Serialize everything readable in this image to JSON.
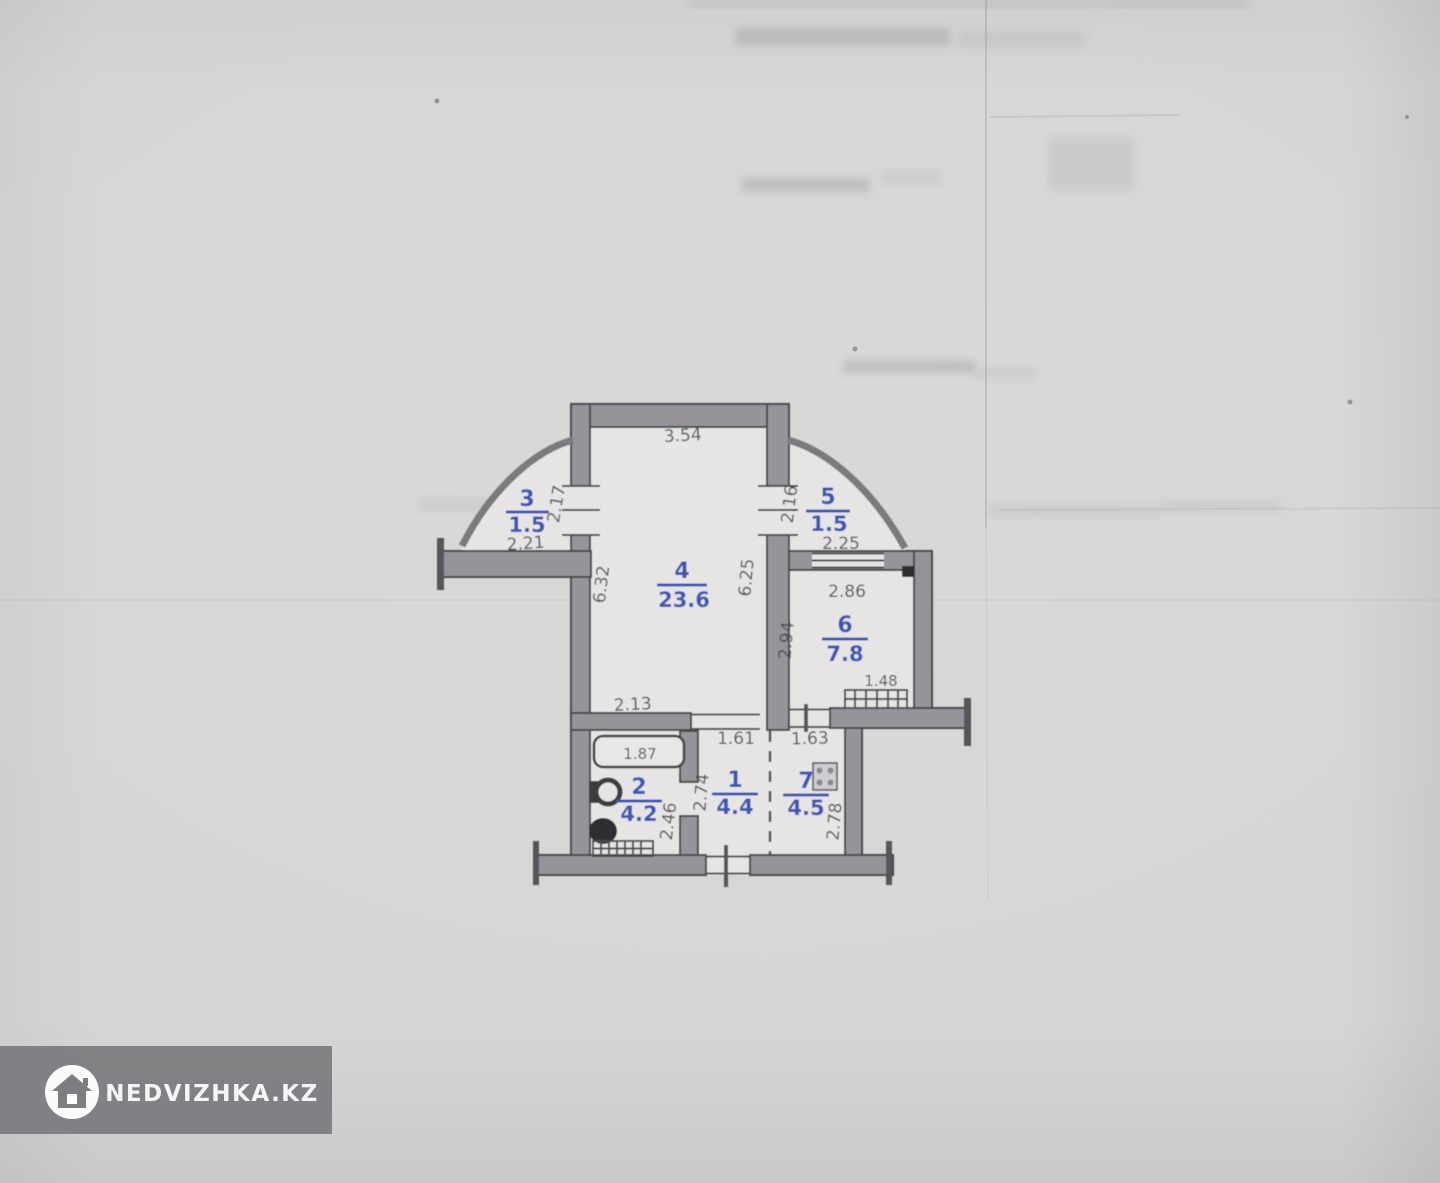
{
  "watermark": {
    "brand": "NEDVIZHKA.KZ",
    "icon": "house-icon"
  },
  "rooms": {
    "hall": {
      "number": "1",
      "area": "4.4"
    },
    "bathroom": {
      "number": "2",
      "area": "4.2"
    },
    "balcony_left": {
      "number": "3",
      "area": "1.5"
    },
    "living": {
      "number": "4",
      "area": "23.6"
    },
    "balcony_right": {
      "number": "5",
      "area": "1.5"
    },
    "kitchen": {
      "number": "6",
      "area": "7.8"
    },
    "corridor": {
      "number": "7",
      "area": "4.5"
    }
  },
  "dims": {
    "living_top_width": "3.54",
    "balcony_left_depth": "2.17",
    "balcony_left_width": "2.21",
    "balcony_right_depth": "2.16",
    "balcony_right_width": "2.25",
    "living_left_height": "6.32",
    "living_right_height": "6.25",
    "kitchen_width": "2.86",
    "kitchen_height": "2.94",
    "duct_width": "1.48",
    "bathroom_top_width": "2.13",
    "bathtub_length": "1.87",
    "hall_top_width": "1.61",
    "corridor_top_width": "1.63",
    "hall_height": "2.74",
    "bathroom_height": "2.46",
    "corridor_height": "2.78"
  },
  "colors": {
    "paper": "#d8d6d4",
    "wall_fill": "#96949a",
    "line": "#46464a",
    "room_label_blue": "#3a55b8",
    "dimension_text": "#47474c",
    "watermark_bar": "#7e7d81"
  }
}
